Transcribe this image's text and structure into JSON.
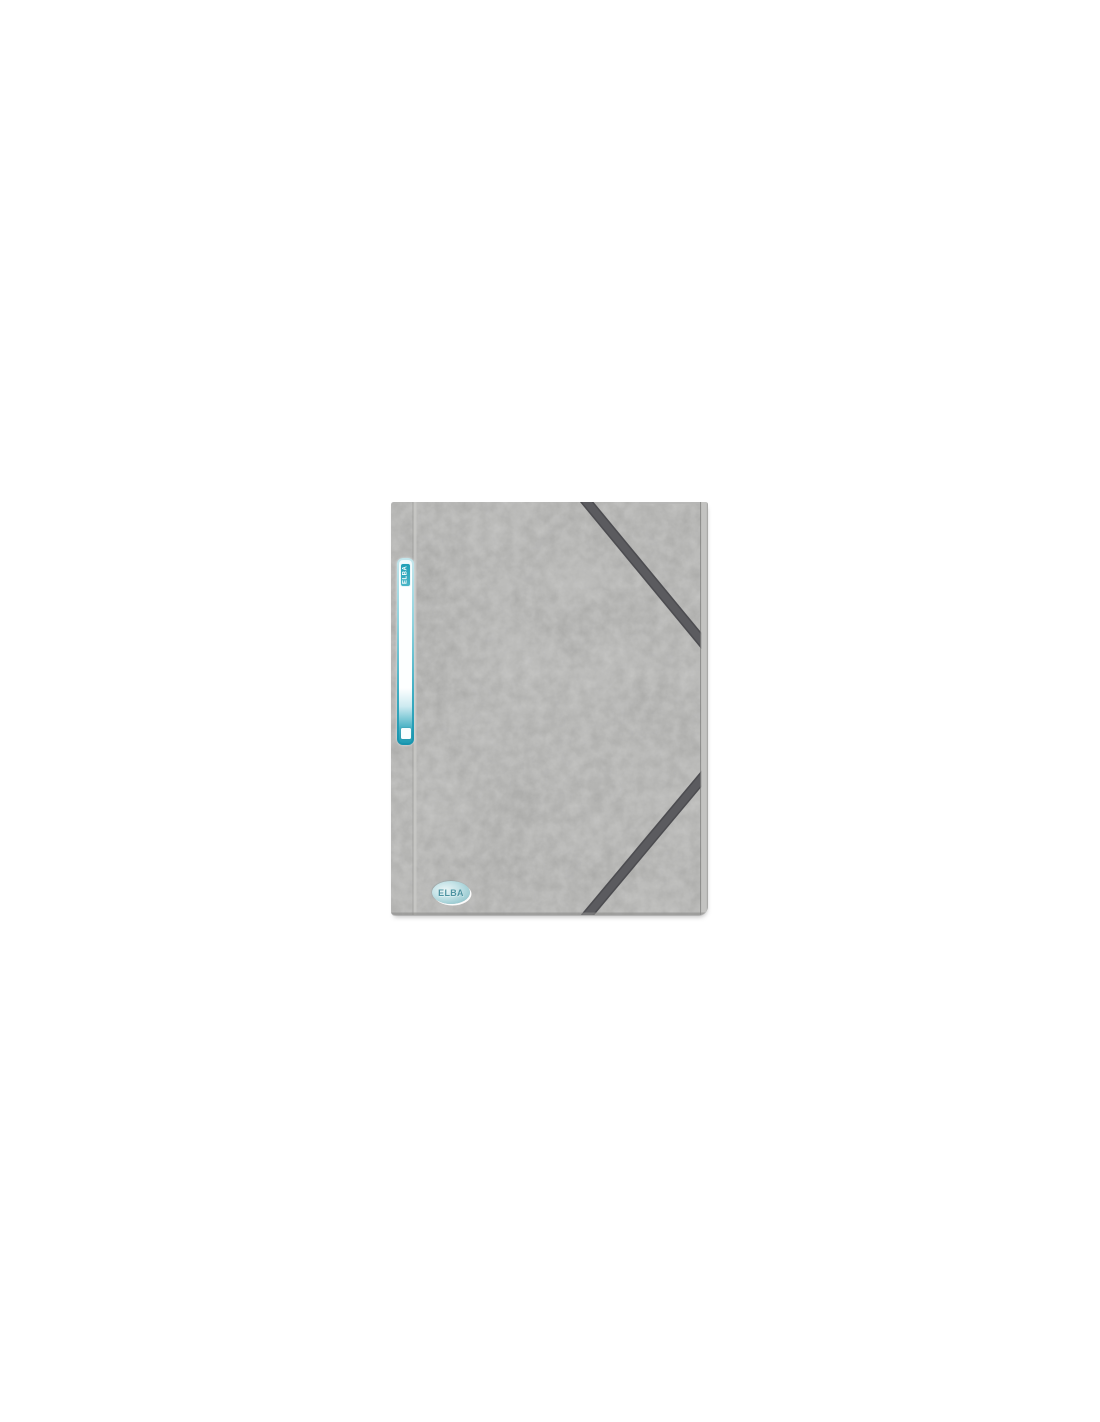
{
  "page": {
    "background_color": "#ffffff"
  },
  "product_photo": {
    "description_of_subject": "grey elasticated folder, front view",
    "brand": "ELBA",
    "label_tag_text": "ELBA",
    "logo_text": "ELBA",
    "colors": {
      "folder_grey": "#a0a09e",
      "folder_mottle_dark": "#8c8c8a",
      "folder_mottle_light": "#bfbfbd",
      "elastic_grey": "#56565a",
      "accent_teal": "#2aa3b9",
      "label_white": "#fdffff",
      "back_edge_grey": "#c3c3c1",
      "background": "#ffffff"
    }
  }
}
